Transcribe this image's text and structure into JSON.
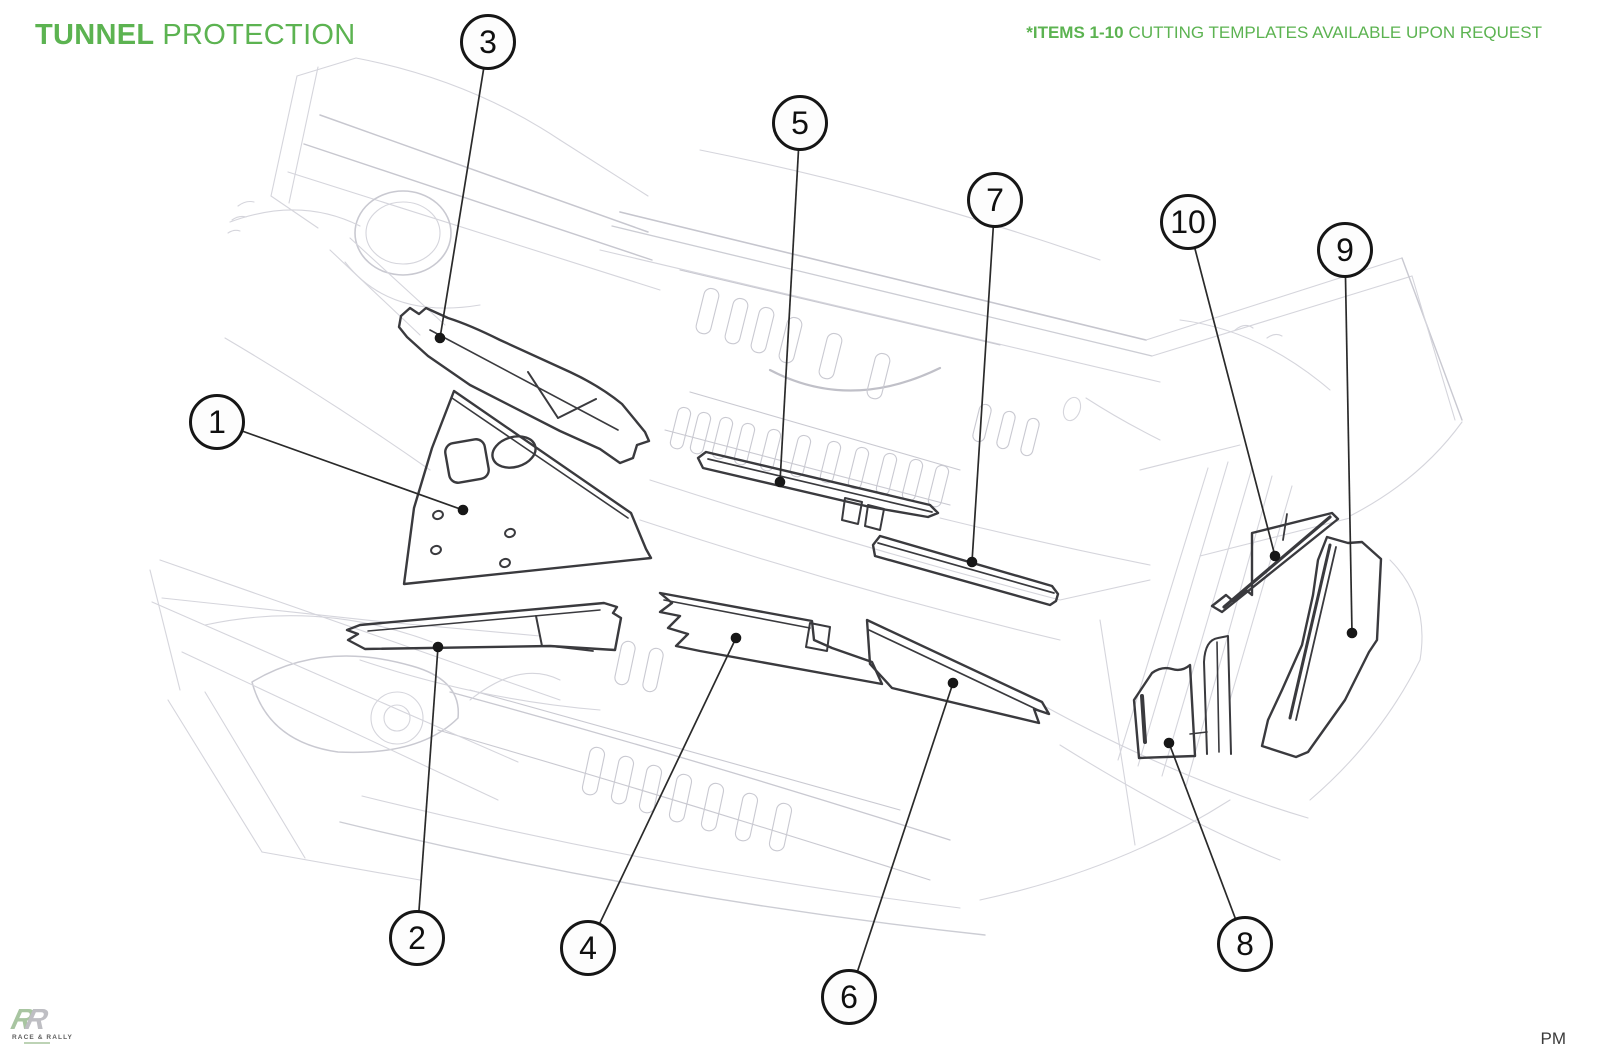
{
  "header": {
    "title_primary": "TUNNEL",
    "title_secondary": "PROTECTION",
    "note_bold": "*ITEMS 1-10",
    "note_text": "CUTTING TEMPLATES AVAILABLE UPON REQUEST"
  },
  "callouts": {
    "labels": [
      "1",
      "2",
      "3",
      "4",
      "5",
      "6",
      "7",
      "8",
      "9",
      "10"
    ]
  },
  "footer": {
    "logo_r1": "R",
    "logo_r2": "R",
    "logo_caption": "RACE & RALLY",
    "initials": "PM"
  },
  "colors": {
    "accent_green": "#5cb351",
    "callout_ink": "#161616",
    "part_outline": "#3a3a3e",
    "sketch_light": "#d5d5dc"
  }
}
